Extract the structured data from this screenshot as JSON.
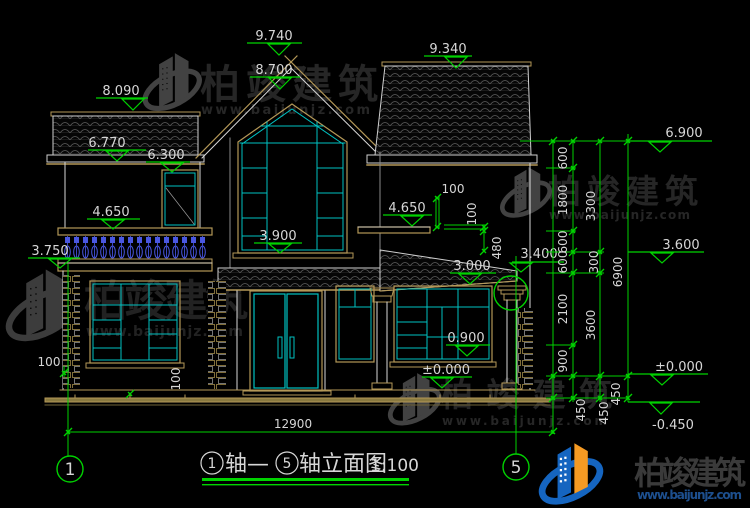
{
  "drawing": {
    "levels": {
      "peak_center": "9.740",
      "under_roof_center": "8.700",
      "peak_right": "9.340",
      "peak_left": "8.090",
      "eave_left": "6.770",
      "door2f_top": "6.300",
      "balcony_rail": "4.650",
      "balcony_slab": "3.750",
      "center_sill": "3.900",
      "ledge_right": "4.650",
      "porch_high": "3.400",
      "porch_low": "3.000",
      "sill_right": "0.900",
      "floor_mid": "±0.000",
      "right_eave": "6.900",
      "right_mid": "3.600",
      "right_zero": "±0.000",
      "right_ground": "-0.450"
    },
    "dims": {
      "a1": "600",
      "a2": "1800",
      "a3": "600",
      "a4": "600",
      "a5": "2100",
      "a6": "900",
      "a7": "450",
      "b1": "3300",
      "b2": "300",
      "b3": "3600",
      "b4": "450",
      "c1": "6900",
      "c2": "450",
      "d100_top": "100",
      "d100_mid": "100",
      "d480": "480",
      "d100_left": "100",
      "d100_left2": "100",
      "total_width": "12900"
    },
    "axes": {
      "left": "1",
      "right": "5"
    },
    "title": {
      "axis1": "1",
      "join": "轴—",
      "axis2": "5",
      "rest": "轴立面图",
      "scale": "1:100"
    }
  },
  "watermark": {
    "name": "柏竣建筑",
    "url": "www.baijunjz.com"
  },
  "colors": {
    "green": "#00d200",
    "cyan": "#00c2c2",
    "tan": "#b49858",
    "baluster_blue": "#4a57e0",
    "logo_blue": "#1565c0",
    "logo_orange": "#f59a23"
  }
}
